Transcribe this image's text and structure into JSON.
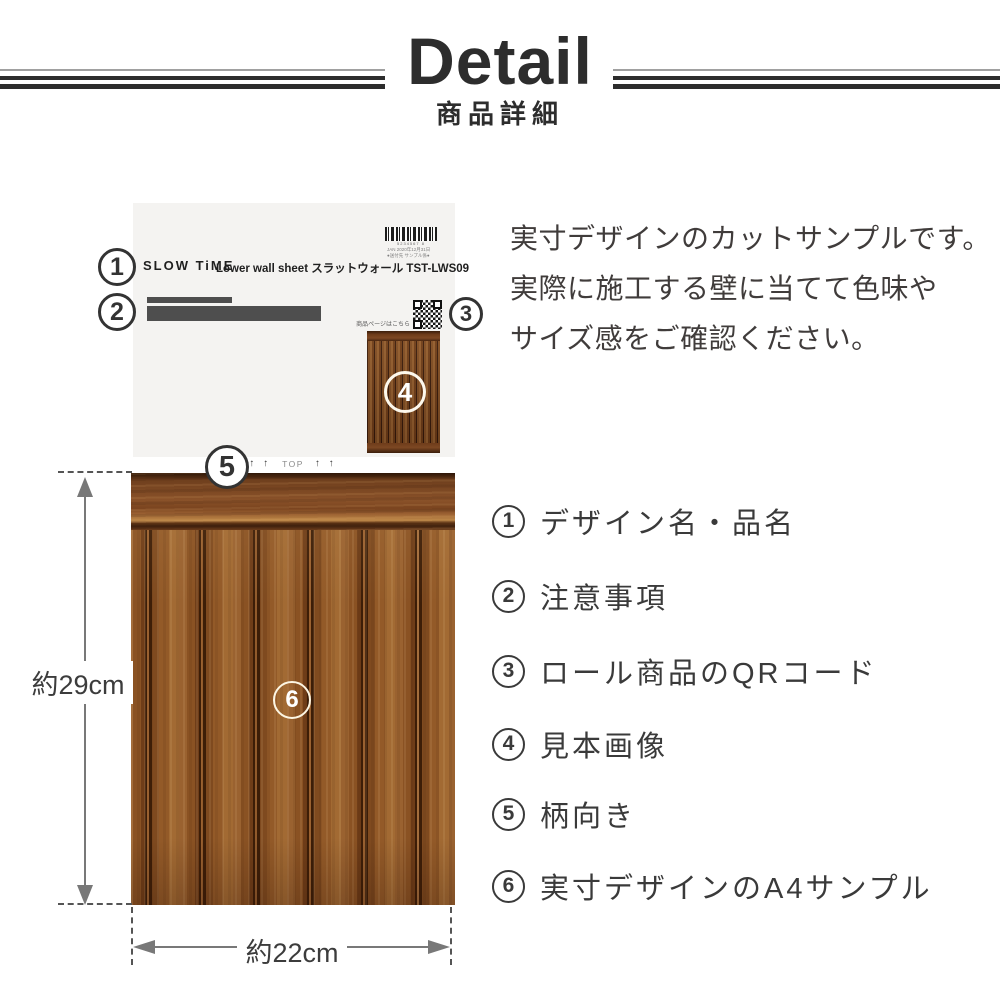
{
  "header": {
    "title": "Detail",
    "subtitle": "商品詳細"
  },
  "sample_sheet": {
    "brand": "SLOW TiME",
    "product_name": "Lower wall sheet スラットウォール TST-LWS09",
    "barcode_number": "5234567 8",
    "barcode_meta_line1": "JAN 2020年12月31日",
    "barcode_meta_line2": "●送付先 サンプル係●",
    "qr_caption": "商品ページはこちら",
    "top_marks": {
      "arrows_left": "↑ ↑",
      "label": "TOP",
      "arrows_right": "↑ ↑"
    }
  },
  "callouts": [
    "1",
    "2",
    "3",
    "4",
    "5",
    "6"
  ],
  "dimensions": {
    "height_label": "約29cm",
    "width_label": "約22cm"
  },
  "description": {
    "line1": "実寸デザインのカットサンプルです。",
    "line2": "実際に施工する壁に当てて色味や",
    "line3": "サイズ感をご確認ください。"
  },
  "legend": {
    "items": [
      {
        "number": "1",
        "label": "デザイン名・品名"
      },
      {
        "number": "2",
        "label": "注意事項"
      },
      {
        "number": "3",
        "label": "ロール商品のQRコード"
      },
      {
        "number": "4",
        "label": "見本画像"
      },
      {
        "number": "5",
        "label": "柄向き"
      },
      {
        "number": "6",
        "label": "実寸デザインのA4サンプル"
      }
    ]
  },
  "colors": {
    "heading_text": "#2d2d2d",
    "body_text": "#3a3a3a",
    "rule_dark": "#2d2d2d",
    "rule_light": "#a0a0a0",
    "paper": "#f4f3f1",
    "redacted_bar": "#4e4e4e",
    "wood_base": "#8a5425",
    "wood_groove": "#3c1d07",
    "wood_rail": "#7c4823",
    "dimension_arrow": "#787878"
  }
}
